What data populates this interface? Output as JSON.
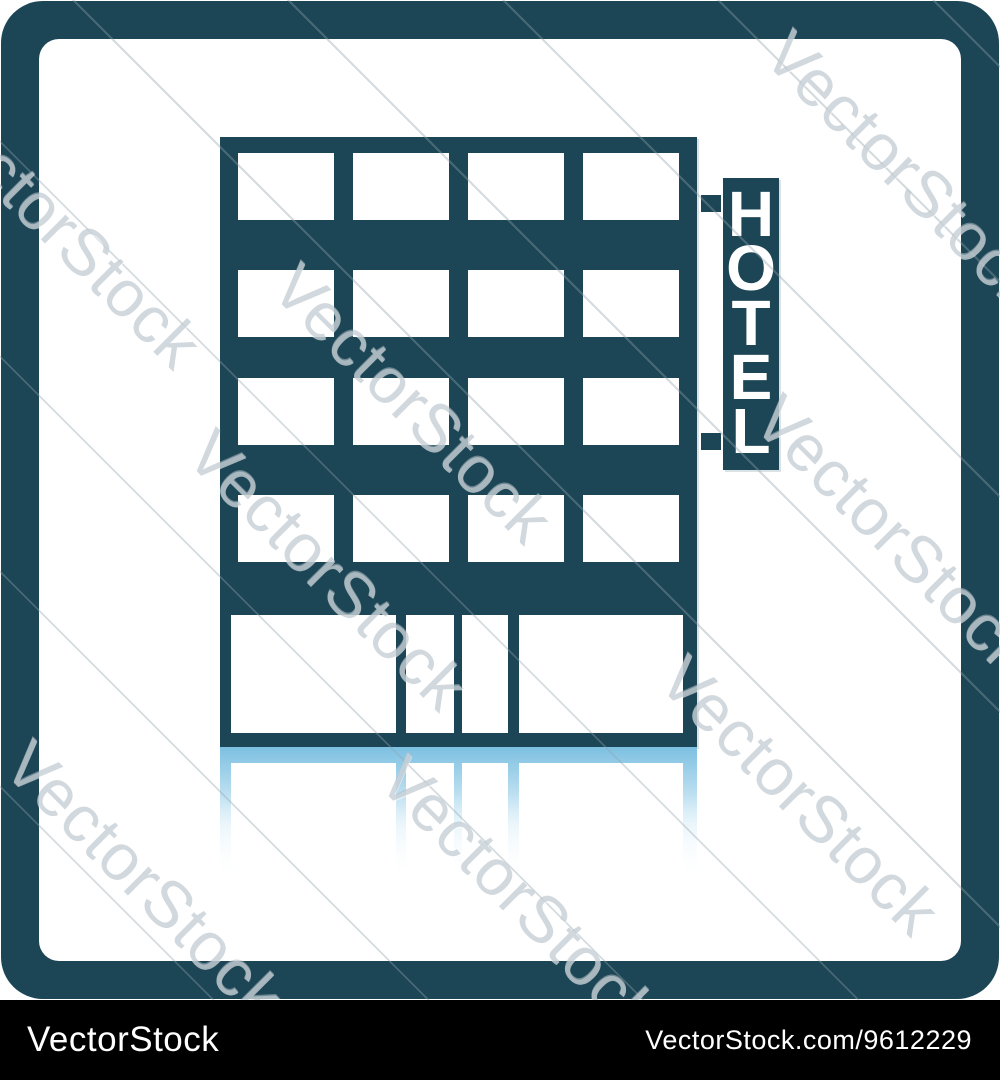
{
  "icon": {
    "name": "hotel-building-icon",
    "description": "Hotel building icon with vertical HOTEL signboard and shadow reflection",
    "sign_letters": [
      "H",
      "O",
      "T",
      "E",
      "L"
    ],
    "colors": {
      "primary": "#1c4555",
      "reflection_blue": "#7cc0e1",
      "background": "#ffffff",
      "watermark_gray": "#adbac2",
      "footer_bg": "#000000",
      "footer_text": "#ffffff"
    }
  },
  "watermark": {
    "text": "VectorStock"
  },
  "footer": {
    "brand": "VectorStock",
    "credit": "VectorStock.com/9612229"
  }
}
